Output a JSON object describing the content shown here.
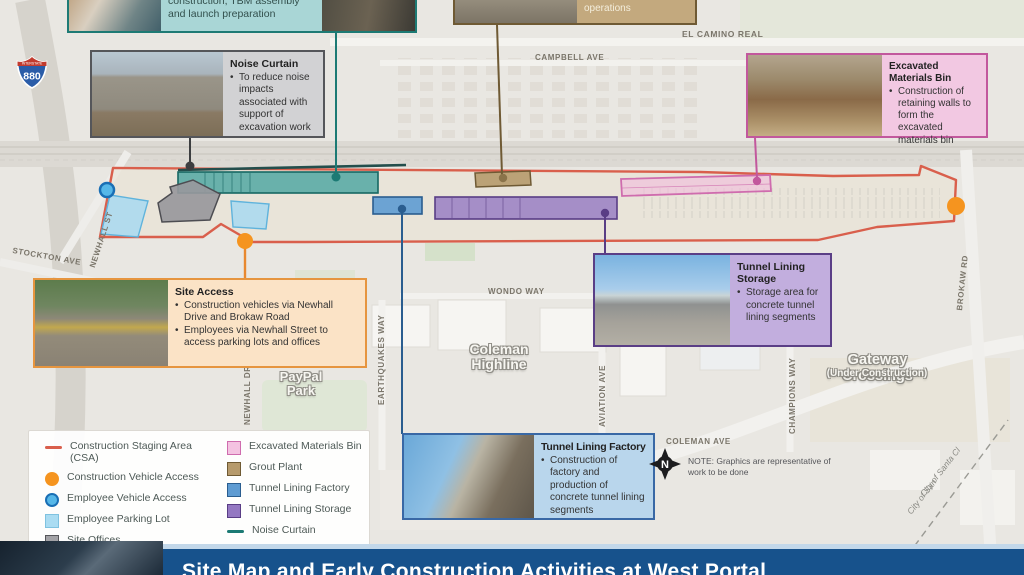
{
  "banner": {
    "title": "Site Map and Early Construction Activities at West Portal"
  },
  "callouts": {
    "west_portal": {
      "text": "construction, TBM assembly and launch preparation"
    },
    "grout_plant": {
      "text": "segments in place during tunneling operations"
    },
    "noise_curtain": {
      "title": "Noise Curtain",
      "body": "To reduce noise impacts associated with support of excavation work"
    },
    "excavated_bin": {
      "title": "Excavated Materials Bin",
      "body": "Construction of retaining walls to form the excavated materials bin"
    },
    "site_access": {
      "title": "Site Access",
      "bullet1": "Construction vehicles via Newhall Drive and Brokaw Road",
      "bullet2": "Employees via Newhall Street to access parking lots and offices"
    },
    "tunnel_lining_storage": {
      "title": "Tunnel Lining Storage",
      "body": "Storage area for concrete tunnel lining segments"
    },
    "tunnel_lining_factory": {
      "title": "Tunnel Lining Factory",
      "body": "Construction of factory and production of concrete tunnel lining segments"
    }
  },
  "legend": {
    "items": [
      {
        "swatch": "line-red",
        "label": "Construction Staging Area (CSA)"
      },
      {
        "swatch": "circle-orange",
        "label": "Construction Vehicle Access"
      },
      {
        "swatch": "circle-blue",
        "label": "Employee Vehicle Access"
      },
      {
        "swatch": "square-lightblue",
        "label": "Employee Parking Lot"
      },
      {
        "swatch": "square-gray",
        "label": "Site Offices"
      },
      {
        "swatch": "square-teal",
        "label": "West Portal/Tunnel Boring Machine (TBM) Shaft"
      },
      {
        "swatch": "square-pink",
        "label": "Excavated Materials Bin"
      },
      {
        "swatch": "square-tan",
        "label": "Grout Plant"
      },
      {
        "swatch": "square-blue",
        "label": "Tunnel Lining Factory"
      },
      {
        "swatch": "square-purple",
        "label": "Tunnel Lining Storage"
      },
      {
        "swatch": "line-teal",
        "label": "Noise Curtain"
      }
    ]
  },
  "streets": {
    "el_camino": "EL CAMINO REAL",
    "campbell": "CAMPBELL AVE",
    "stockton": "STOCKTON AVE",
    "newhall_st": "NEWHALL ST",
    "newhall_dr": "NEWHALL DR",
    "earthquakes": "EARTHQUAKES WAY",
    "wondo": "WONDO WAY",
    "aviation": "AVIATION AVE",
    "champions": "CHAMPIONS WAY",
    "brokaw": "BROKAW RD",
    "coleman": "COLEMAN AVE"
  },
  "areas": {
    "paypal": "PayPal Park",
    "coleman_highline": "Coleman Highline",
    "gateway": "Gateway Crossings",
    "gateway_sub": "(Under Construction)",
    "city_boundary_1": "City of Santa Cl",
    "city_boundary_2": "City of San"
  },
  "note": "NOTE: Graphics are representative of work to be done",
  "shield": {
    "top": "INTERSTATE",
    "number": "880"
  },
  "colors": {
    "csa_red": "#d95f4c",
    "access_orange": "#f5941f",
    "employee_blue": "#56b7e8",
    "parking_lightblue": "#aadcf2",
    "offices_gray": "#a2a2a6",
    "tbm_teal": "#45a39d",
    "bin_pink": "#f4c3e1",
    "grout_tan": "#b69a6c",
    "factory_blue": "#5e9bd2",
    "storage_purple": "#9478c2",
    "noise_teal": "#1c7a74",
    "banner_blue": "#17528c"
  }
}
